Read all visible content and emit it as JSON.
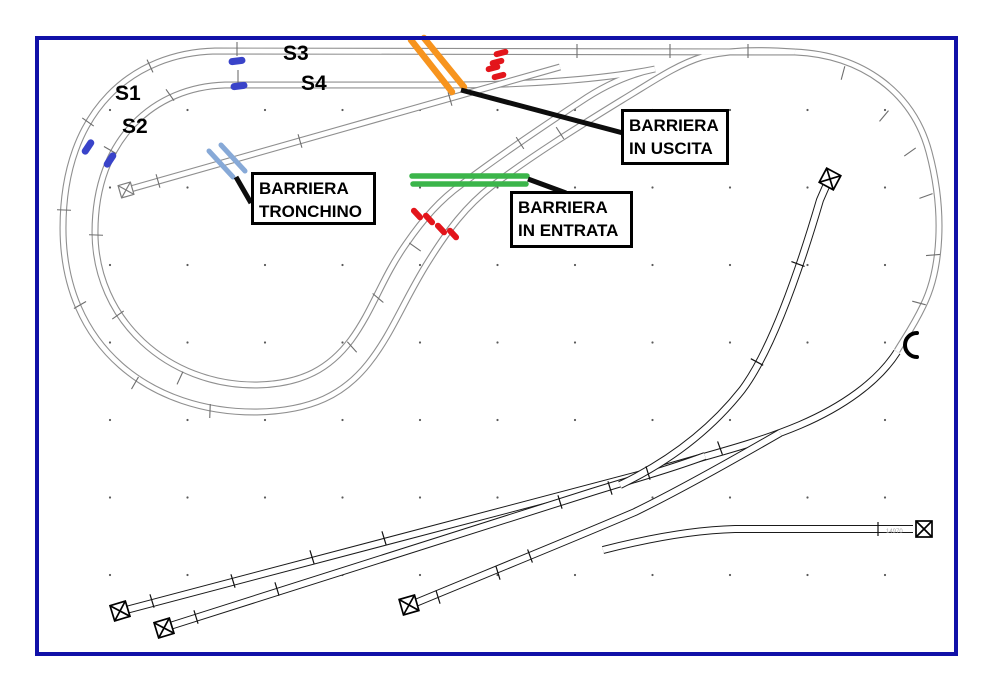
{
  "signals": {
    "s1": "S1",
    "s2": "S2",
    "s3": "S3",
    "s4": "S4"
  },
  "callouts": {
    "tronchino": {
      "line1": "BARRIERA",
      "line2": "TRONCHINO"
    },
    "uscita": {
      "line1": "BARRIERA",
      "line2": "IN USCITA"
    },
    "entrata": {
      "line1": "BARRIERA",
      "line2": "IN ENTRATA"
    }
  },
  "track_part_label": "14970",
  "colors": {
    "frame": "#1111A8",
    "track": "#8F8F8F",
    "yard": "#1A1A1A",
    "barrier-orange": "#F7941E",
    "barrier-green": "#3BB54A",
    "barrier-blue": "#87A9D7",
    "signal-blue": "#3943C9",
    "gap-red": "#E3151B",
    "callout": "#0D0D0D",
    "grid-dot": "#5A5A5A"
  }
}
